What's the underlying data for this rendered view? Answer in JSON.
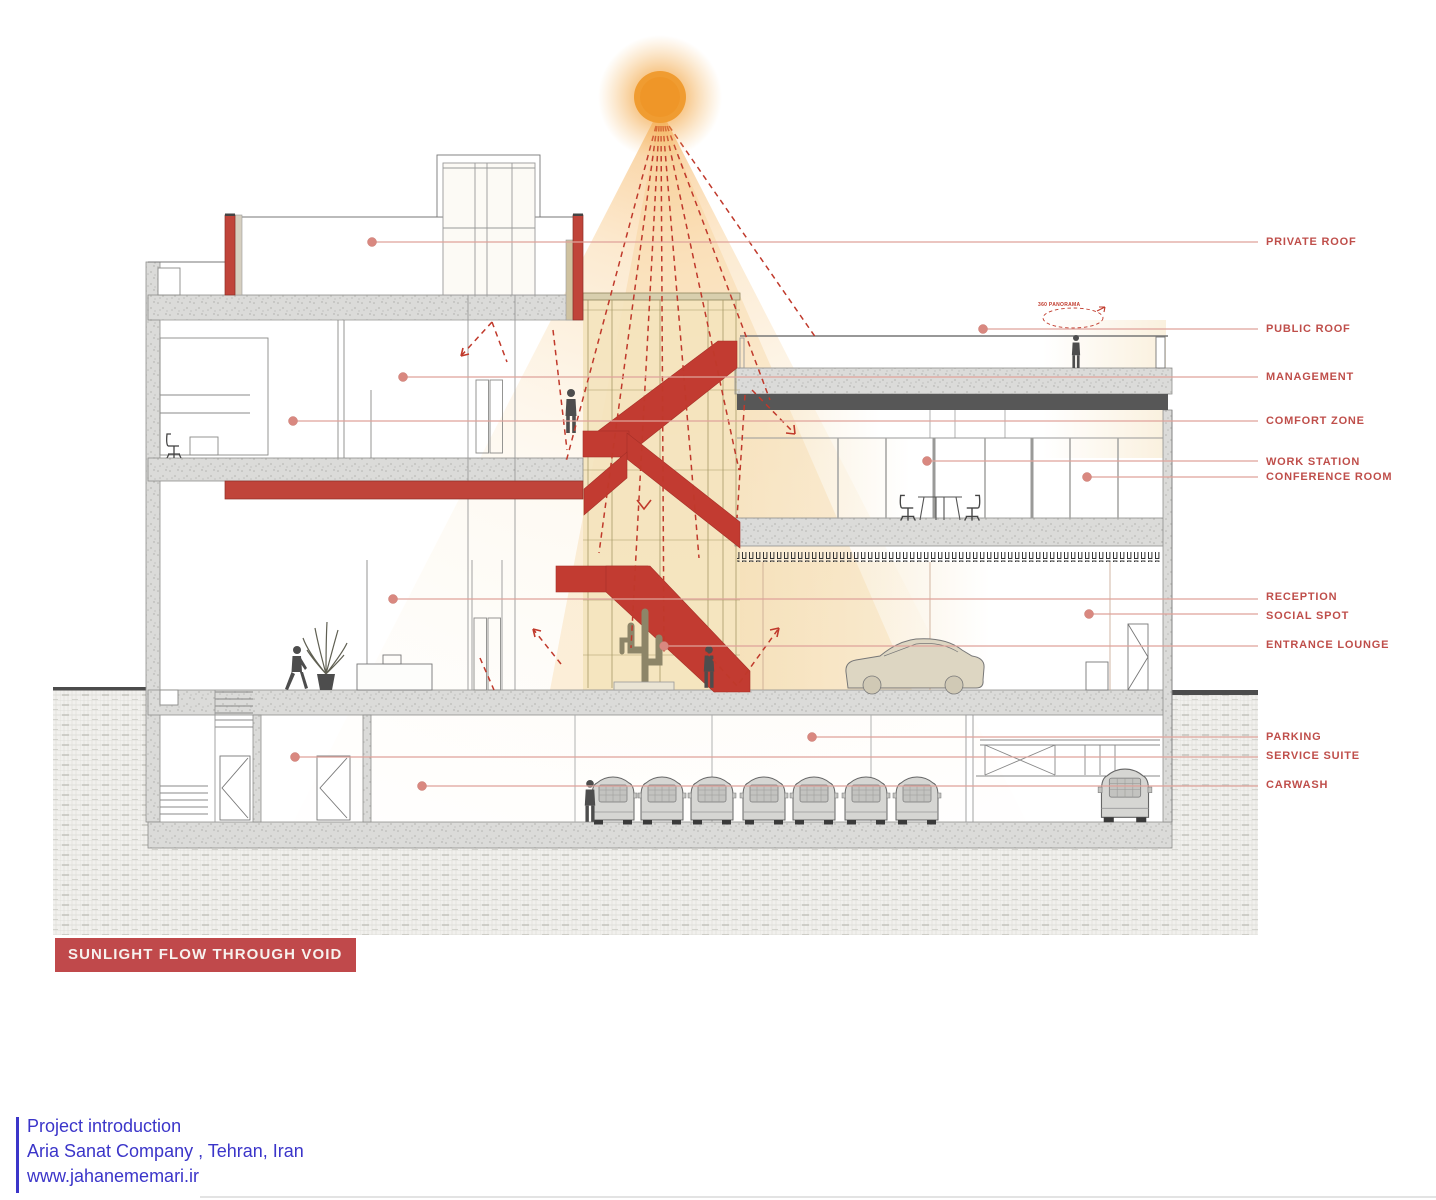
{
  "title_box": {
    "label": "SUNLIGHT FLOW THROUGH VOID"
  },
  "callouts": [
    {
      "id": "private-roof",
      "text": "PRIVATE ROOF"
    },
    {
      "id": "public-roof",
      "text": "PUBLIC ROOF"
    },
    {
      "id": "management",
      "text": "MANAGEMENT"
    },
    {
      "id": "comfort-zone",
      "text": "COMFORT ZONE"
    },
    {
      "id": "work-station",
      "text": "WORK STATION"
    },
    {
      "id": "conference-room",
      "text": "CONFERENCE ROOM"
    },
    {
      "id": "reception",
      "text": "RECEPTION"
    },
    {
      "id": "social-spot",
      "text": "SOCIAL SPOT"
    },
    {
      "id": "entrance-lounge",
      "text": "ENTRANCE LOUNGE"
    },
    {
      "id": "parking",
      "text": "PARKING"
    },
    {
      "id": "service-suite",
      "text": "SERVICE SUITE"
    },
    {
      "id": "carwash",
      "text": "CARWASH"
    }
  ],
  "annotations": {
    "panorama": "360 PANORAMA"
  },
  "footer": {
    "line1": "Project introduction",
    "line2": "Aria Sanat Company , Tehran, Iran",
    "line3": "www.jahanememari.ir"
  },
  "colors": {
    "stair_red": "#c23b31",
    "label_red": "#bf4e4a",
    "leader_pink": "#dfa29a",
    "sun_orange": "#f09a2d",
    "footer_blue": "#3b35c9",
    "beam_dark": "#575757"
  }
}
